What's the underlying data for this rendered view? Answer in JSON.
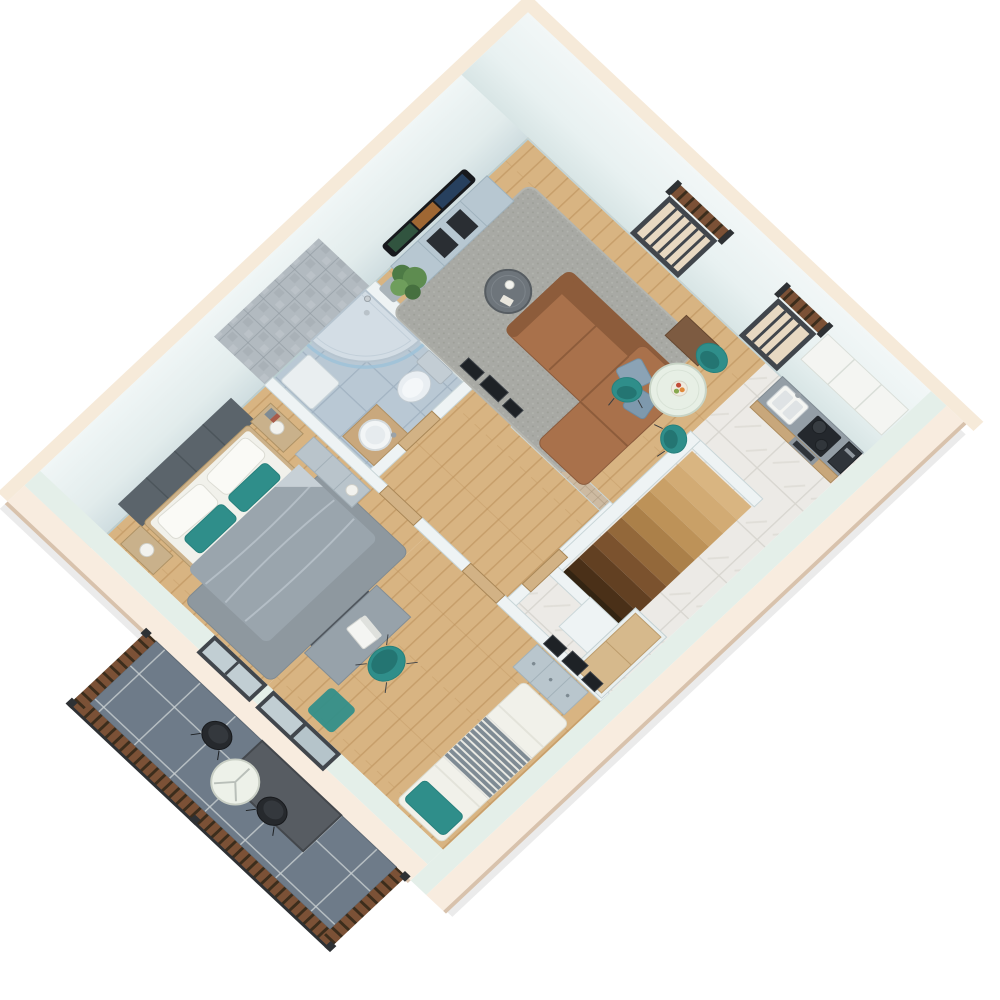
{
  "scene": {
    "type": "3d-isometric-floor-plan-render",
    "style": "dollhouse cutaway, viewed from above at 45 degrees",
    "background": "#ffffff",
    "visible_text": ""
  },
  "palette": {
    "wood": "#d8b482",
    "woodLine": "#b98e58",
    "marble": "#eceae6",
    "marbleLine": "#d8d6d0",
    "bathTile": "#b9c8d4",
    "bathTileLine": "#a2b3c2",
    "balconyTile": "#6e7b89",
    "balconyLine": "#c9cfd2",
    "wallFace": "#dfe9ea",
    "wallFaceLight": "#eef4f4",
    "wallCut": "#e4efe9",
    "exteriorCream": "#f8ecdf",
    "creamEdge": "#d8c2ac",
    "interiorWall": "#eef3f4",
    "interiorWallEdge": "#c9d6d8",
    "teal": "#2f8e8a",
    "tealDark": "#247572",
    "couch": "#a9714b",
    "couchDark": "#8d5c3b",
    "rugLiving": "#a8a9a4",
    "rugBedroom": "#8e989f",
    "duvet": "#9aa5ad",
    "headboard": "#5b646b",
    "doorWood": "#d2b285",
    "frameDark": "#41464c",
    "railWood": "#7b5136",
    "railDark": "#2e3134",
    "counter": "#949ea6",
    "cabinetWood": "#c8a77b",
    "applianceDark": "#2b3036",
    "stone": "#b2bac0",
    "mosaic": "#cdbaa1",
    "screenPanel": "#575c62",
    "chairBlack": "#26292d",
    "white": "#f4f5f2"
  },
  "rooms": [
    {
      "id": "living-room",
      "floor": "wood",
      "furniture": [
        "curved-tv",
        "tv-console",
        "potted-plant",
        "gray-rug",
        "round-coffee-table",
        "brown-l-sofa",
        "blue-pillows",
        "wall-frames",
        "wood-sideboard"
      ]
    },
    {
      "id": "dining-area",
      "floor": "wood",
      "furniture": [
        "round-dining-table",
        "fruit-bowl",
        "teal-armchair",
        "teal-chair",
        "teal-chair"
      ]
    },
    {
      "id": "kitchen",
      "floor": "marble",
      "furniture": [
        "sink",
        "faucet",
        "cooktop",
        "two-pots",
        "oven",
        "coffee-machine",
        "upper-cabinets",
        "wood-base-cabinets"
      ]
    },
    {
      "id": "entry-hall",
      "floor": "marble",
      "furniture": [
        "staircase-down",
        "chimney-column",
        "cabinet-with-wood-top"
      ]
    },
    {
      "id": "corridor",
      "floor": "wood",
      "furniture": [
        "mosaic-accent-wall",
        "wood-doors"
      ]
    },
    {
      "id": "bathroom",
      "floor": "blue-tile",
      "furniture": [
        "corner-shower",
        "glass-screen",
        "toilet",
        "round-basin-vanity",
        "low-cabinet",
        "stone-wall-tiles"
      ]
    },
    {
      "id": "master-bedroom",
      "floor": "wood",
      "furniture": [
        "upholstered-headboard",
        "double-bed",
        "teal-pillows",
        "gray-duvet",
        "nightstand-lamp-x2",
        "dresser-lamp",
        "gray-rug"
      ]
    },
    {
      "id": "office-bedroom",
      "floor": "wood",
      "furniture": [
        "desk",
        "laptop",
        "desk-panel",
        "teal-desk-chair",
        "drawer-chest",
        "wall-frames-x3",
        "single-bed",
        "teal-pillow",
        "striped-blanket",
        "teal-rug",
        "sliding-balcony-door"
      ]
    },
    {
      "id": "balcony",
      "floor": "dark-tile",
      "furniture": [
        "wood-railing",
        "privacy-screen",
        "black-chair",
        "black-chair",
        "round-white-table"
      ]
    }
  ],
  "counts": {
    "dining_chairs": 3,
    "balcony_chairs": 2,
    "stair_steps": 9,
    "living_wall_frames": 3,
    "office_wall_frames": 3,
    "french_balcony_windows": 2
  },
  "stairs": {
    "step_colors": [
      "#d9b581",
      "#d2ab74",
      "#c9a067",
      "#bd9258",
      "#ab8049",
      "#93683a",
      "#7b522e",
      "#624022",
      "#4a3018"
    ]
  }
}
